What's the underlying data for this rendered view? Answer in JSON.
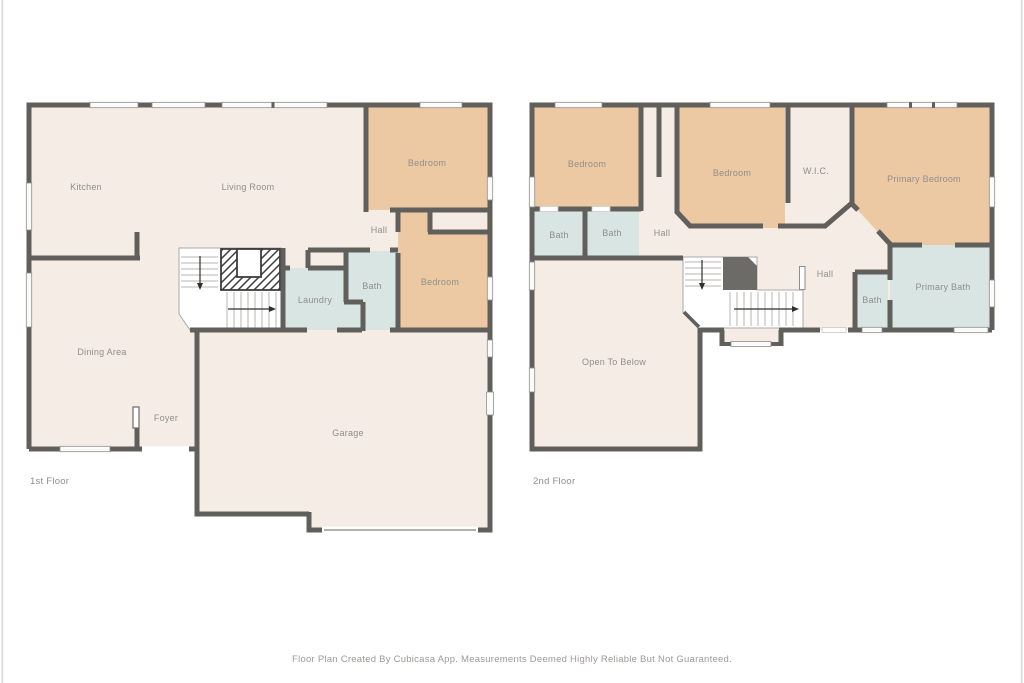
{
  "colors": {
    "background": "#ffffff",
    "wall": "#615f5c",
    "floor": "#f4ece5",
    "bedroom": "#ecc9a3",
    "wet_room": "#d8e5e2",
    "stairwell": "#6d6b68",
    "window_fill": "#fbfbfa",
    "label": "#908e8b",
    "footer_text": "#9c9a98"
  },
  "floor1": {
    "title": "1st Floor",
    "rooms": {
      "kitchen": "Kitchen",
      "living": "Living Room",
      "bedroom_top": "Bedroom",
      "hall": "Hall",
      "bath": "Bath",
      "bedroom_right": "Bedroom",
      "laundry": "Laundry",
      "dining": "Dining Area",
      "foyer": "Foyer",
      "garage": "Garage"
    }
  },
  "floor2": {
    "title": "2nd Floor",
    "rooms": {
      "bedroom_left": "Bedroom",
      "bedroom_mid": "Bedroom",
      "wic": "W.I.C.",
      "primary_bedroom": "Primary Bedroom",
      "bath_left": "Bath",
      "bath_mid": "Bath",
      "hall_upper": "Hall",
      "hall_lower": "Hall",
      "bath_small": "Bath",
      "primary_bath": "Primary Bath",
      "open_below": "Open To Below"
    }
  },
  "footer": {
    "disclaimer": "Floor Plan Created By Cubicasa App. Measurements Deemed Highly Reliable But Not Guaranteed."
  }
}
